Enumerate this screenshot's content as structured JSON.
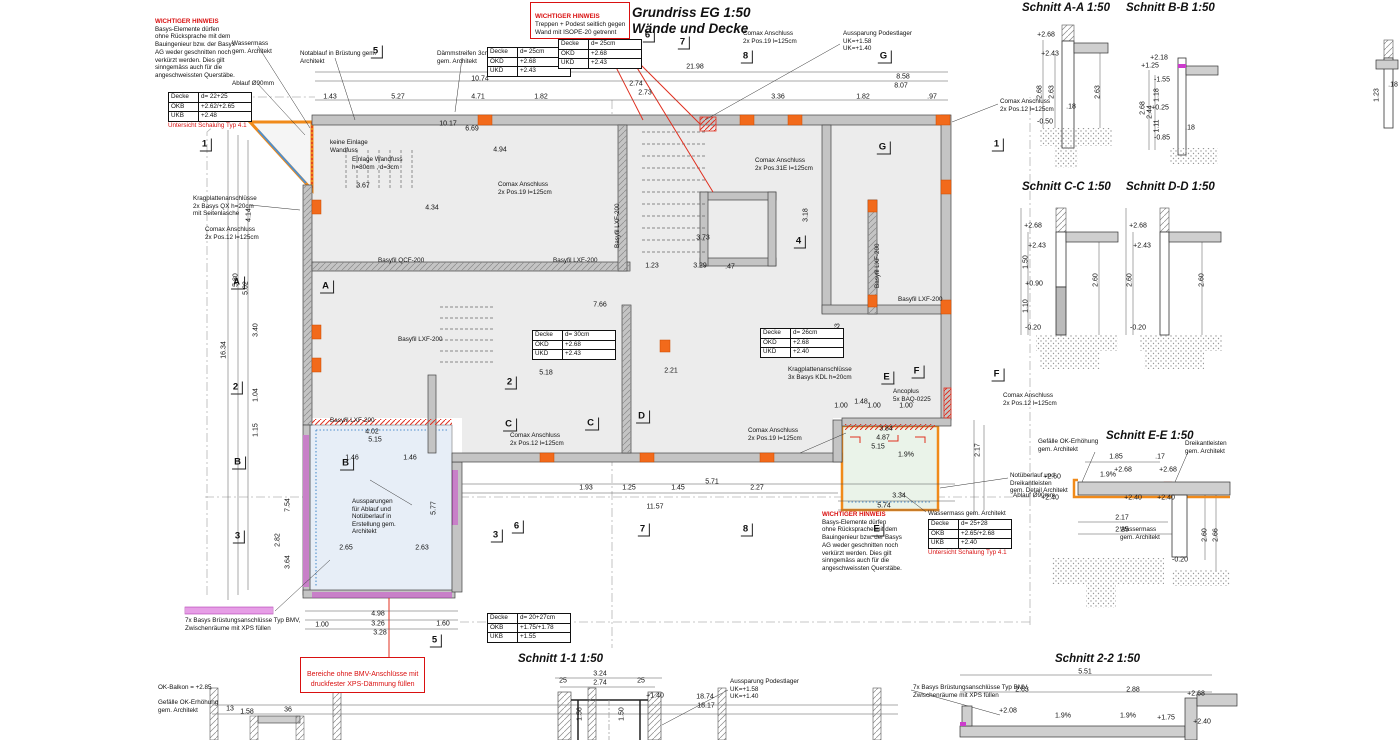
{
  "title": {
    "line1": "Grundriss EG 1:50",
    "line2": "Wände und Decke"
  },
  "colors": {
    "accent_orange": "#f08a1a",
    "note_red": "#d91111",
    "magenta": "#cc3ccc",
    "blue_edge": "#4f8fcc",
    "wall_gray": "#c4c4c4",
    "floor_gray": "#ececec",
    "balcony_blue": "#e7eef7",
    "balcony_green": "#eaf3e9"
  },
  "notes": {
    "warn_heading": "WICHTIGER HINWEIS",
    "warn_body": "Basys-Elemente dürfen\nohne Rücksprache mit dem\nBauingenieur bzw. der Basys\nAG weder geschnitten noch\nverkürzt werden. Dies gilt\nsinngemäss auch für die\nangeschweissten Querstäbe.",
    "top_box_heading": "WICHTIGER HINWEIS",
    "top_box_body": "Treppen + Podest seitlich gegen\nWand mit ISOPE-20 getrennt",
    "bottom_box": "Bereiche ohne BMV-Anschlüsse mit\ndruckfester XPS-Dämmung füllen"
  },
  "section_titles": [
    {
      "x": 1022,
      "y": 2,
      "t": "Schnitt A-A 1:50"
    },
    {
      "x": 1126,
      "y": 2,
      "t": "Schnitt B-B 1:50"
    },
    {
      "x": 1022,
      "y": 181,
      "t": "Schnitt C-C 1:50"
    },
    {
      "x": 1126,
      "y": 181,
      "t": "Schnitt D-D 1:50"
    },
    {
      "x": 1106,
      "y": 430,
      "t": "Schnitt E-E 1:50"
    },
    {
      "x": 518,
      "y": 653,
      "t": "Schnitt 1-1 1:50"
    },
    {
      "x": 1055,
      "y": 653,
      "t": "Schnitt 2-2 1:50"
    }
  ],
  "grid_labels": [
    {
      "x": 377,
      "y": 52,
      "t": "5"
    },
    {
      "x": 549,
      "y": 60,
      "t": "H"
    },
    {
      "x": 649,
      "y": 36,
      "t": "6"
    },
    {
      "x": 684,
      "y": 43,
      "t": "7"
    },
    {
      "x": 747,
      "y": 57,
      "t": "8"
    },
    {
      "x": 885,
      "y": 57,
      "t": "G"
    },
    {
      "x": 206,
      "y": 145,
      "t": "1"
    },
    {
      "x": 238,
      "y": 283,
      "t": "A"
    },
    {
      "x": 237,
      "y": 388,
      "t": "2"
    },
    {
      "x": 239,
      "y": 463,
      "t": "B"
    },
    {
      "x": 239,
      "y": 537,
      "t": "3"
    },
    {
      "x": 327,
      "y": 287,
      "t": "A"
    },
    {
      "x": 511,
      "y": 383,
      "t": "2"
    },
    {
      "x": 347,
      "y": 464,
      "t": "B"
    },
    {
      "x": 510,
      "y": 425,
      "t": "C"
    },
    {
      "x": 592,
      "y": 424,
      "t": "C"
    },
    {
      "x": 643,
      "y": 417,
      "t": "D"
    },
    {
      "x": 497,
      "y": 536,
      "t": "3"
    },
    {
      "x": 436,
      "y": 641,
      "t": "5"
    },
    {
      "x": 518,
      "y": 527,
      "t": "6"
    },
    {
      "x": 644,
      "y": 530,
      "t": "7"
    },
    {
      "x": 747,
      "y": 530,
      "t": "8"
    },
    {
      "x": 878,
      "y": 530,
      "t": "E"
    },
    {
      "x": 888,
      "y": 378,
      "t": "E"
    },
    {
      "x": 918,
      "y": 372,
      "t": "F"
    },
    {
      "x": 998,
      "y": 375,
      "t": "F"
    },
    {
      "x": 884,
      "y": 148,
      "t": "G"
    },
    {
      "x": 998,
      "y": 145,
      "t": "1"
    },
    {
      "x": 800,
      "y": 242,
      "t": "4"
    }
  ],
  "annotations": [
    {
      "x": 232,
      "y": 40,
      "t": "Wassermass\ngem. Architekt"
    },
    {
      "x": 300,
      "y": 50,
      "t": "Notablauf in Brüstung gem.\nArchitekt"
    },
    {
      "x": 232,
      "y": 80,
      "t": "Ablauf Ø90mm"
    },
    {
      "x": 437,
      "y": 50,
      "t": "Dämmstreifen 3cm\ngem. Architekt"
    },
    {
      "x": 330,
      "y": 139,
      "t": "keine Einlage\nWandfuss"
    },
    {
      "x": 352,
      "y": 156,
      "t": "Einlage Wandfuss\nh=80cm , d=3cm"
    },
    {
      "x": 193,
      "y": 195,
      "t": "Kragplattenanschlüsse\n2x Basys QX h=20cm\nmit Seitenlasche"
    },
    {
      "x": 205,
      "y": 226,
      "t": "Comax Anschluss\n2x Pos.12 l=125cm"
    },
    {
      "x": 498,
      "y": 181,
      "t": "Comax Anschluss\n2x Pos.19 l=125cm"
    },
    {
      "x": 755,
      "y": 157,
      "t": "Comax Anschluss\n2x Pos.31E l=125cm"
    },
    {
      "x": 743,
      "y": 30,
      "t": "Comax Anschluss\n2x Pos.19 l=125cm"
    },
    {
      "x": 843,
      "y": 30,
      "t": "Aussparung Podestlager\nUK=+1.58\nUK=+1.40"
    },
    {
      "x": 1000,
      "y": 98,
      "t": "Comax Anschluss\n2x Pos.12 l=125cm"
    },
    {
      "x": 510,
      "y": 432,
      "t": "Comax Anschluss\n2x Pos.12 l=125cm"
    },
    {
      "x": 748,
      "y": 427,
      "t": "Comax Anschluss\n2x Pos.19 l=125cm"
    },
    {
      "x": 788,
      "y": 366,
      "t": "Kragplattenanschlüsse\n3x Basys KDL h=20cm"
    },
    {
      "x": 893,
      "y": 388,
      "t": "Ancoplus\n5x BAQ-0225"
    },
    {
      "x": 1003,
      "y": 392,
      "t": "Comax Anschluss\n2x Pos.12 l=125cm"
    },
    {
      "x": 1010,
      "y": 472,
      "t": "Notüberlauf und\nDreikantleisten\ngem. Detail Architekt"
    },
    {
      "x": 1013,
      "y": 492,
      "t": "Ablauf Ø90mm"
    },
    {
      "x": 928,
      "y": 510,
      "t": "Wassermass gem. Architekt"
    },
    {
      "x": 352,
      "y": 498,
      "t": "Aussparungen\nfür Ablauf und\nNotüberlauf in\nErstellung gem.\nArchitekt"
    },
    {
      "x": 1038,
      "y": 438,
      "t": "Gefälle OK-Erhöhung\ngem. Architekt"
    },
    {
      "x": 1185,
      "y": 440,
      "t": "Dreikantleisten\ngem. Architekt"
    },
    {
      "x": 1120,
      "y": 526,
      "t": "Wassermass\ngem. Architekt"
    },
    {
      "x": 158,
      "y": 684,
      "t": "OK-Balkon = +2.85"
    },
    {
      "x": 158,
      "y": 699,
      "t": "Gefälle OK-Erhöhung\ngem. Architekt"
    },
    {
      "x": 185,
      "y": 617,
      "t": "7x Basys Brüstungsanschlüsse Typ BMV,\nZwischenräume mit XPS füllen"
    },
    {
      "x": 913,
      "y": 684,
      "t": "7x Basys Brüstungsanschlüsse Typ BMV,\nZwischenräume mit XPS füllen"
    },
    {
      "x": 730,
      "y": 678,
      "t": "Aussparung Podestlager\nUK=+1.58\nUK=+1.40"
    },
    {
      "x": 378,
      "y": 257,
      "t": "Basyfil QCF-200"
    },
    {
      "x": 553,
      "y": 257,
      "t": "Basyfil LXF-200"
    },
    {
      "x": 898,
      "y": 296,
      "t": "Basyfil LXF-200"
    },
    {
      "x": 398,
      "y": 336,
      "t": "Basyfil LXF-200"
    },
    {
      "x": 330,
      "y": 417,
      "t": "Basyfil LXF-200"
    },
    {
      "x": 614,
      "y": 248,
      "t": "Basyfil LXF-200",
      "v": true
    },
    {
      "x": 874,
      "y": 288,
      "t": "Basyfil LXF-200",
      "v": true
    }
  ],
  "dims": [
    {
      "x": 695,
      "y": 67,
      "t": "21.98"
    },
    {
      "x": 480,
      "y": 79,
      "t": "10.74"
    },
    {
      "x": 903,
      "y": 77,
      "t": "8.58"
    },
    {
      "x": 901,
      "y": 86,
      "t": "8.07"
    },
    {
      "x": 330,
      "y": 97,
      "t": "1.43"
    },
    {
      "x": 398,
      "y": 97,
      "t": "5.27"
    },
    {
      "x": 478,
      "y": 97,
      "t": "4.71"
    },
    {
      "x": 541,
      "y": 97,
      "t": "1.82"
    },
    {
      "x": 636,
      "y": 84,
      "t": "2.74"
    },
    {
      "x": 645,
      "y": 93,
      "t": "2.73"
    },
    {
      "x": 778,
      "y": 97,
      "t": "3.36"
    },
    {
      "x": 863,
      "y": 97,
      "t": "1.82"
    },
    {
      "x": 932,
      "y": 97,
      "t": ".97"
    },
    {
      "x": 448,
      "y": 124,
      "t": "10.17"
    },
    {
      "x": 472,
      "y": 129,
      "t": "6.69"
    },
    {
      "x": 500,
      "y": 150,
      "t": "4.94"
    },
    {
      "x": 432,
      "y": 208,
      "t": "4.34"
    },
    {
      "x": 363,
      "y": 186,
      "t": "3.67"
    },
    {
      "x": 224,
      "y": 350,
      "t": "16.34",
      "r": true
    },
    {
      "x": 236,
      "y": 280,
      "t": "5.80",
      "r": true
    },
    {
      "x": 246,
      "y": 288,
      "t": "5.02",
      "r": true
    },
    {
      "x": 249,
      "y": 215,
      "t": "4.14",
      "r": true
    },
    {
      "x": 256,
      "y": 330,
      "t": "3.40",
      "r": true
    },
    {
      "x": 256,
      "y": 395,
      "t": "1.04",
      "r": true
    },
    {
      "x": 256,
      "y": 430,
      "t": "1.15",
      "r": true
    },
    {
      "x": 288,
      "y": 505,
      "t": "7.54",
      "r": true
    },
    {
      "x": 278,
      "y": 540,
      "t": "2.82",
      "r": true
    },
    {
      "x": 288,
      "y": 562,
      "t": "3.64",
      "r": true
    },
    {
      "x": 372,
      "y": 432,
      "t": "4.02"
    },
    {
      "x": 375,
      "y": 440,
      "t": "5.15"
    },
    {
      "x": 352,
      "y": 458,
      "t": "1.46"
    },
    {
      "x": 410,
      "y": 458,
      "t": "1.46"
    },
    {
      "x": 346,
      "y": 548,
      "t": "2.65"
    },
    {
      "x": 422,
      "y": 548,
      "t": "2.63"
    },
    {
      "x": 434,
      "y": 508,
      "t": "5.77",
      "r": true
    },
    {
      "x": 322,
      "y": 625,
      "t": "1.00"
    },
    {
      "x": 378,
      "y": 614,
      "t": "4.98"
    },
    {
      "x": 378,
      "y": 624,
      "t": "3.26"
    },
    {
      "x": 443,
      "y": 624,
      "t": "1.60"
    },
    {
      "x": 380,
      "y": 633,
      "t": "3.28"
    },
    {
      "x": 886,
      "y": 429,
      "t": "3.84"
    },
    {
      "x": 883,
      "y": 438,
      "t": "4.87"
    },
    {
      "x": 878,
      "y": 447,
      "t": "5.15"
    },
    {
      "x": 906,
      "y": 455,
      "t": "1.9%"
    },
    {
      "x": 899,
      "y": 496,
      "t": "3.34"
    },
    {
      "x": 884,
      "y": 506,
      "t": "5.74"
    },
    {
      "x": 978,
      "y": 450,
      "t": "2.17",
      "r": true
    },
    {
      "x": 841,
      "y": 406,
      "t": "1.00"
    },
    {
      "x": 874,
      "y": 406,
      "t": "1.00"
    },
    {
      "x": 906,
      "y": 406,
      "t": "1.00"
    },
    {
      "x": 546,
      "y": 373,
      "t": "5.18"
    },
    {
      "x": 600,
      "y": 305,
      "t": "7.66"
    },
    {
      "x": 671,
      "y": 371,
      "t": "2.21"
    },
    {
      "x": 703,
      "y": 238,
      "t": "3.73"
    },
    {
      "x": 700,
      "y": 266,
      "t": "3.29"
    },
    {
      "x": 730,
      "y": 267,
      "t": ".47"
    },
    {
      "x": 652,
      "y": 266,
      "t": "1.23"
    },
    {
      "x": 586,
      "y": 488,
      "t": "1.93"
    },
    {
      "x": 629,
      "y": 488,
      "t": "1.25"
    },
    {
      "x": 678,
      "y": 488,
      "t": "1.45"
    },
    {
      "x": 712,
      "y": 482,
      "t": "5.71"
    },
    {
      "x": 757,
      "y": 488,
      "t": "2.27"
    },
    {
      "x": 655,
      "y": 507,
      "t": "11.57"
    },
    {
      "x": 806,
      "y": 215,
      "t": "3.18",
      "r": true
    },
    {
      "x": 838,
      "y": 330,
      "t": "6.53",
      "r": true
    },
    {
      "x": 861,
      "y": 402,
      "t": "1.48"
    },
    {
      "x": 1046,
      "y": 35,
      "t": "+2.68"
    },
    {
      "x": 1050,
      "y": 54,
      "t": "+2.43"
    },
    {
      "x": 1040,
      "y": 92,
      "t": "2.68",
      "r": true
    },
    {
      "x": 1052,
      "y": 92,
      "t": "2.63",
      "r": true
    },
    {
      "x": 1098,
      "y": 92,
      "t": "2.63",
      "r": true
    },
    {
      "x": 1045,
      "y": 122,
      "t": "-0.50"
    },
    {
      "x": 1071,
      "y": 107,
      "t": ".18"
    },
    {
      "x": 1159,
      "y": 58,
      "t": "+2.18"
    },
    {
      "x": 1150,
      "y": 66,
      "t": "+1.25"
    },
    {
      "x": 1162,
      "y": 80,
      "t": "-1.55"
    },
    {
      "x": 1160,
      "y": 108,
      "t": "+0.25"
    },
    {
      "x": 1162,
      "y": 138,
      "t": "-0.85"
    },
    {
      "x": 1143,
      "y": 108,
      "t": "2.68",
      "r": true
    },
    {
      "x": 1150,
      "y": 112,
      "t": "2.44",
      "r": true
    },
    {
      "x": 1157,
      "y": 95,
      "t": "1.18",
      "r": true
    },
    {
      "x": 1157,
      "y": 126,
      "t": "1.11",
      "r": true
    },
    {
      "x": 1190,
      "y": 128,
      "t": ".18"
    },
    {
      "x": 1033,
      "y": 226,
      "t": "+2.68"
    },
    {
      "x": 1037,
      "y": 246,
      "t": "+2.43"
    },
    {
      "x": 1026,
      "y": 262,
      "t": "1.50",
      "r": true
    },
    {
      "x": 1034,
      "y": 284,
      "t": "+0.90"
    },
    {
      "x": 1026,
      "y": 306,
      "t": "1.10",
      "r": true
    },
    {
      "x": 1033,
      "y": 328,
      "t": "-0.20"
    },
    {
      "x": 1096,
      "y": 280,
      "t": "2.60",
      "r": true
    },
    {
      "x": 1138,
      "y": 226,
      "t": "+2.68"
    },
    {
      "x": 1142,
      "y": 246,
      "t": "+2.43"
    },
    {
      "x": 1130,
      "y": 280,
      "t": "2.60",
      "r": true
    },
    {
      "x": 1138,
      "y": 328,
      "t": "-0.20"
    },
    {
      "x": 1202,
      "y": 280,
      "t": "2.60",
      "r": true
    },
    {
      "x": 1052,
      "y": 477,
      "t": "+2.60"
    },
    {
      "x": 1050,
      "y": 498,
      "t": "+2.40"
    },
    {
      "x": 1123,
      "y": 470,
      "t": "+2.68"
    },
    {
      "x": 1168,
      "y": 470,
      "t": "+2.68"
    },
    {
      "x": 1133,
      "y": 498,
      "t": "+2.40"
    },
    {
      "x": 1166,
      "y": 498,
      "t": "+2.40"
    },
    {
      "x": 1108,
      "y": 475,
      "t": "1.9%"
    },
    {
      "x": 1116,
      "y": 457,
      "t": "1.85"
    },
    {
      "x": 1160,
      "y": 457,
      "t": ".17"
    },
    {
      "x": 1122,
      "y": 518,
      "t": "2.17"
    },
    {
      "x": 1122,
      "y": 530,
      "t": "2.25"
    },
    {
      "x": 1180,
      "y": 560,
      "t": "-0.20"
    },
    {
      "x": 1205,
      "y": 535,
      "t": "2.60",
      "r": true
    },
    {
      "x": 1216,
      "y": 535,
      "t": "2.66",
      "r": true
    },
    {
      "x": 600,
      "y": 674,
      "t": "3.24"
    },
    {
      "x": 600,
      "y": 683,
      "t": "2.74"
    },
    {
      "x": 563,
      "y": 681,
      "t": "25"
    },
    {
      "x": 641,
      "y": 681,
      "t": "25"
    },
    {
      "x": 580,
      "y": 714,
      "t": "1.56",
      "r": true
    },
    {
      "x": 622,
      "y": 714,
      "t": "1.50",
      "r": true
    },
    {
      "x": 655,
      "y": 696,
      "t": "+1.40"
    },
    {
      "x": 1085,
      "y": 672,
      "t": "5.51"
    },
    {
      "x": 1022,
      "y": 690,
      "t": "2.63"
    },
    {
      "x": 1133,
      "y": 690,
      "t": "2.88"
    },
    {
      "x": 1196,
      "y": 694,
      "t": "+2.68"
    },
    {
      "x": 1008,
      "y": 711,
      "t": "+2.08"
    },
    {
      "x": 1166,
      "y": 718,
      "t": "+1.75"
    },
    {
      "x": 1202,
      "y": 722,
      "t": "+2.40"
    },
    {
      "x": 1063,
      "y": 716,
      "t": "1.9%"
    },
    {
      "x": 1128,
      "y": 716,
      "t": "1.9%"
    },
    {
      "x": 705,
      "y": 697,
      "t": "18.74"
    },
    {
      "x": 706,
      "y": 706,
      "t": "18.17"
    },
    {
      "x": 247,
      "y": 712,
      "t": "1.58"
    },
    {
      "x": 230,
      "y": 709,
      "t": "13"
    },
    {
      "x": 288,
      "y": 710,
      "t": "36"
    },
    {
      "x": 1377,
      "y": 95,
      "t": "1.23",
      "r": true
    },
    {
      "x": 1393,
      "y": 85,
      "t": ".18"
    }
  ],
  "deck_tables": [
    {
      "x": 168,
      "y": 92,
      "rows": [
        [
          "Decke",
          "d= 22+25"
        ],
        [
          "OKB",
          "+2.62/+2.65"
        ],
        [
          "UKB",
          "+2.48"
        ]
      ],
      "note": "Untersicht Schalung Typ 4.1"
    },
    {
      "x": 487,
      "y": 47,
      "rows": [
        [
          "Decke",
          "d= 25cm"
        ],
        [
          "OKD",
          "+2.68"
        ],
        [
          "UKD",
          "+2.43"
        ]
      ]
    },
    {
      "x": 558,
      "y": 39,
      "rows": [
        [
          "Decke",
          "d= 25cm"
        ],
        [
          "OKD",
          "+2.68"
        ],
        [
          "UKD",
          "+2.43"
        ]
      ]
    },
    {
      "x": 532,
      "y": 330,
      "rows": [
        [
          "Decke",
          "d= 30cm"
        ],
        [
          "OKD",
          "+2.68"
        ],
        [
          "UKD",
          "+2.43"
        ]
      ]
    },
    {
      "x": 760,
      "y": 328,
      "rows": [
        [
          "Decke",
          "d= 26cm"
        ],
        [
          "OKD",
          "+2.68"
        ],
        [
          "UKD",
          "+2.40"
        ]
      ]
    },
    {
      "x": 928,
      "y": 519,
      "rows": [
        [
          "Decke",
          "d= 25+28"
        ],
        [
          "OKB",
          "+2.65/+2.68"
        ],
        [
          "UKB",
          "+2.40"
        ]
      ],
      "note": "Untersicht Schalung Typ 4.1"
    },
    {
      "x": 487,
      "y": 613,
      "rows": [
        [
          "Decke",
          "d= 20+27cm"
        ],
        [
          "OKB",
          "+1.75/+1.78"
        ],
        [
          "UKB",
          "+1.55"
        ]
      ]
    }
  ]
}
